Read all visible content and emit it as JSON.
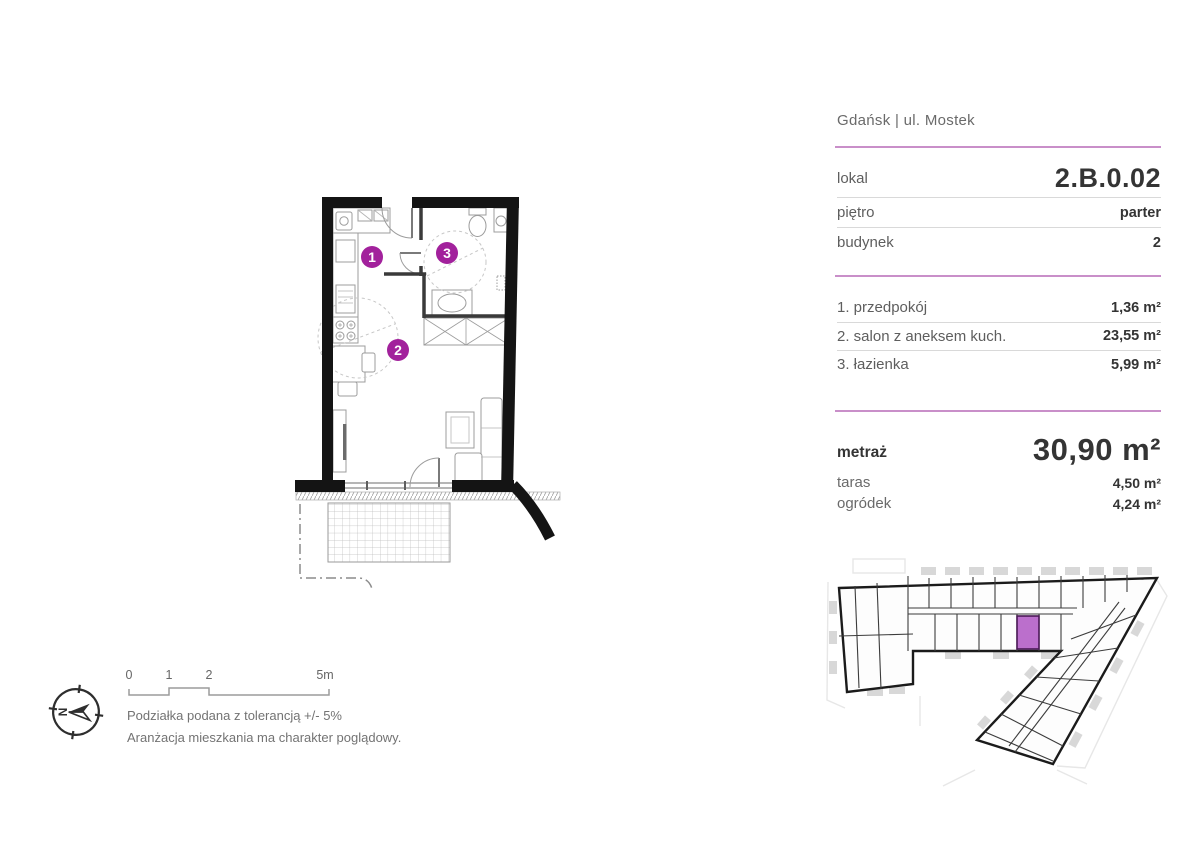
{
  "header": {
    "location": "Gdańsk | ul. Mostek"
  },
  "details": {
    "rows": [
      {
        "label": "lokal",
        "value": "2.B.0.02"
      },
      {
        "label": "piętro",
        "value": "parter"
      },
      {
        "label": "budynek",
        "value": "2"
      }
    ]
  },
  "rooms": [
    {
      "label": "1. przedpokój",
      "area": "1,36 m²"
    },
    {
      "label": "2. salon z aneksem kuch.",
      "area": "23,55 m²"
    },
    {
      "label": "3. łazienka",
      "area": "5,99 m²"
    }
  ],
  "summary": {
    "metraz_label": "metraż",
    "metraz_value": "30,90 m²",
    "taras_label": "taras",
    "taras_value": "4,50 m²",
    "ogrodek_label": "ogródek",
    "ogrodek_value": "4,24 m²"
  },
  "plan": {
    "markers": [
      {
        "number": "1"
      },
      {
        "number": "2"
      },
      {
        "number": "3"
      }
    ],
    "compass_letter": "N"
  },
  "scale_bar": {
    "labels": [
      "0",
      "1",
      "2",
      "5m"
    ]
  },
  "notes": [
    "Podziałka podana z tolerancją +/- 5%",
    "Aranżacja mieszkania ma charakter poglądowy."
  ],
  "colors": {
    "accent": "#a2219c",
    "divider": "#c98fc9",
    "unit_highlight": "#bb6fcc",
    "wall": "#141414"
  }
}
